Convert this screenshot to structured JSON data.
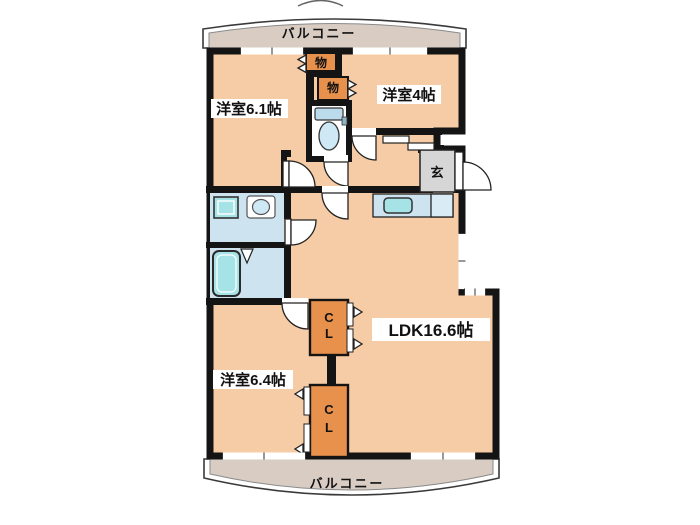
{
  "labels": {
    "balcony_top": "バルコニー",
    "balcony_bottom": "バルコニー",
    "room_top_left": "洋室6.1帖",
    "room_top_right": "洋室4帖",
    "room_bottom_left": "洋室6.4帖",
    "ldk": "LDK16.6帖",
    "genkan": "玄",
    "storage_top": "物",
    "storage_mid": "物",
    "closet_upper_line1": "C",
    "closet_upper_line2": "L",
    "closet_lower_line1": "C",
    "closet_lower_line2": "L"
  },
  "colors": {
    "wall": "#141414",
    "floor": "#f5cca6",
    "balcony": "#d8ccc3",
    "water": "#cde3f0",
    "water_light": "#d9ecf6",
    "fixture": "#a5e3e6",
    "storage": "#e8914d",
    "genkan": "#d6d6d6",
    "tank": "#bcdcee",
    "bowl": "#cfe8f5"
  }
}
